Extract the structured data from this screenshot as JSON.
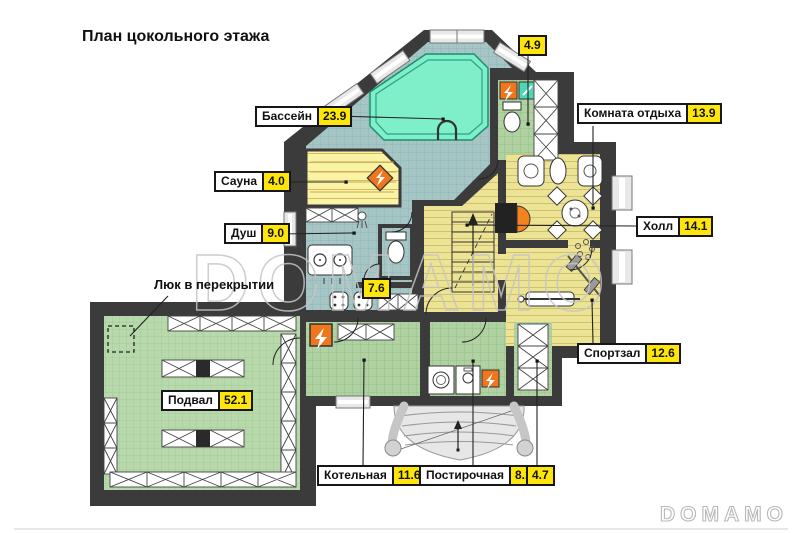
{
  "title": "План цокольного этажа",
  "watermark": {
    "text": "DOMAMO"
  },
  "notes": {
    "hatch": "Люк в перекрытии"
  },
  "labels": {
    "pool": {
      "name": "Бассейн",
      "area": "23.9"
    },
    "wc_top": {
      "area": "4.9"
    },
    "rest": {
      "name": "Комната отдыха",
      "area": "13.9"
    },
    "hall": {
      "name": "Холл",
      "area": "14.1"
    },
    "sauna": {
      "name": "Сауна",
      "area": "4.0"
    },
    "shower": {
      "name": "Душ",
      "area": "9.0"
    },
    "washroom": {
      "area": "7.6"
    },
    "gym": {
      "name": "Спортзал",
      "area": "12.6"
    },
    "cellar": {
      "name": "Подвал",
      "area": "52.1"
    },
    "boiler": {
      "name": "Котельная",
      "area": "11.6"
    },
    "laundry": {
      "name": "Постирочная",
      "area": "8.1"
    },
    "wc_bottom": {
      "area": "4.7"
    }
  },
  "colors": {
    "wall": "#3b3b3b",
    "pool_water": "#7fefca",
    "tile_blue": "#a6c6c6",
    "tile_green": "#b0d2a2",
    "tile_cellar": "#b7d9ab",
    "floor_yellow": "#ece394",
    "sauna_yellow": "#f9f3a6",
    "label_value_bg": "#ffe60a",
    "equipment_orange": "#f0761e",
    "equipment_teal": "#4fd6b4"
  }
}
